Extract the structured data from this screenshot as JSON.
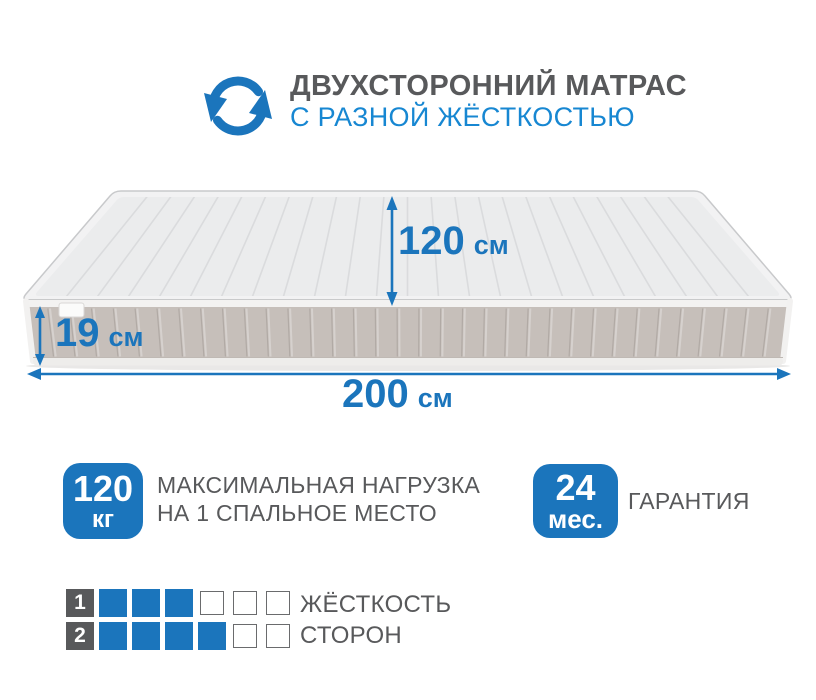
{
  "header": {
    "icon": "rotate-arrows-icon",
    "title": "ДВУХСТОРОННИЙ МАТРАС",
    "subtitle": "С РАЗНОЙ ЖЁСТКОСТЬЮ"
  },
  "mattress": {
    "dimensions": {
      "width": {
        "value": "120",
        "unit": "см"
      },
      "height": {
        "value": "19",
        "unit": "см"
      },
      "length": {
        "value": "200",
        "unit": "см"
      }
    }
  },
  "features": [
    {
      "badge_value": "120",
      "badge_unit": "кг",
      "label_line1": "МАКСИМАЛЬНАЯ НАГРУЗКА",
      "label_line2": "НА 1 СПАЛЬНОЕ МЕСТО"
    },
    {
      "badge_value": "24",
      "badge_unit": "мес.",
      "label_line1": "ГАРАНТИЯ",
      "label_line2": ""
    }
  ],
  "firmness": {
    "rows": [
      {
        "label": "1",
        "filled": 3,
        "total": 6
      },
      {
        "label": "2",
        "filled": 4,
        "total": 6
      }
    ],
    "caption_line1": "ЖЁСТКОСТЬ",
    "caption_line2": "СТОРОН"
  },
  "colors": {
    "accent_blue": "#1B75BC",
    "subtitle_blue": "#1787D2",
    "text_gray": "#58595B",
    "square_border": "#6A6B6D"
  }
}
